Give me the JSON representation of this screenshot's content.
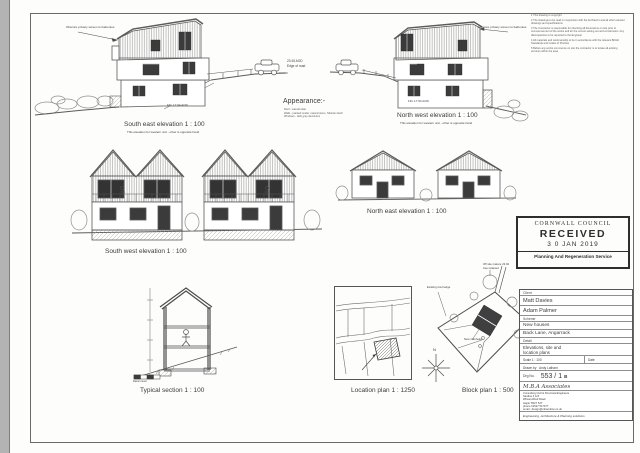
{
  "colors": {
    "ink": "#3c3c3c",
    "line": "#5a5a5a",
    "window": "#3b3b3b",
    "stamp": "#2e2e2e"
  },
  "elevations": {
    "south_east": {
      "title": "South east elevation  1 : 100",
      "subtitle": "This elevation for western unit - other is opposite hand",
      "privacy_note": "Obscure privacy screen to balconies",
      "ffl": "FFL 17.94 AOD",
      "road_level_1": "23.45 AOD",
      "road_level_2": "Edge of road"
    },
    "north_west": {
      "title": "North west elevation  1 : 100",
      "subtitle": "This elevation for western unit - other is opposite hand",
      "privacy_note": "Obscure privacy screen to balconies",
      "ffl": "FFL 17.94 AOD"
    },
    "south_west": {
      "title": "South west elevation  1 : 100"
    },
    "north_east": {
      "title": "North east elevation  1 : 100"
    }
  },
  "appearance": {
    "heading": "Appearance:-",
    "lines": [
      "Roof - natural slate",
      "Walls - painted render, natural stone, Siberian larch",
      "Windows - dark grey aluminium"
    ]
  },
  "notes": [
    "1  This drawing is copyright",
    "2  The drawings to be read in conjunction with the Architect's and all other relevant drawings and specifications",
    "3  The Contractor is responsible for checking all dimensions on site prior to commencement of the works and for the correct setting out and construction. Any discrepancies to be reported to the Engineer",
    "4  All materials and workmanship to be in accordance with the relevant British Standards and Codes of Practice",
    "5  Before any works commence on site the contractor is to locate all existing services within the area"
  ],
  "section": {
    "title": "Typical section  1 : 100",
    "datum_label": "Datum level"
  },
  "location_plan": {
    "title": "Location plan  1 : 1250"
  },
  "block_plan": {
    "title": "Block plan  1 : 500",
    "north": "N",
    "ann_hedge": "Existing low hedge",
    "ann_manholes": "New manholes",
    "ann_tree_1": "Off site mature 23.02",
    "ann_tree_2": "tree retained"
  },
  "stamp": {
    "line1": "CORNWALL COUNCIL",
    "line2": "RECEIVED",
    "line3": "3 0 JAN 2019",
    "line4": "Planning And Regeneration Service"
  },
  "title_block": {
    "client_label": "Client",
    "client1": "Matt Davies",
    "client2": "Adam Palmer",
    "scheme_label": "Scheme",
    "scheme1": "New houses",
    "scheme2": "Back Lane, Angarrack",
    "detail_label": "Detail",
    "detail1": "Elevations, site and",
    "detail2": "location plans",
    "scale_label": "Scale   1 : 100",
    "date_label": "Date",
    "drawnby_label": "Drawn by",
    "drawnby": "Andy Latham",
    "drg_label": "Drg No.",
    "drg_no": "553 / 1",
    "drg_rev": "B",
    "firm": "M.B.A Associates",
    "firm_lines": [
      "Consulting Civil & Structural Engineers",
      "Studios 4 & 8",
      "Wheal Alfred Road",
      "Hayle TR27 5JT",
      "phone 01527 517377",
      "email : design@mbaonline.co.uk"
    ],
    "tagline": "Engineering, Architecture & Planning solutions"
  }
}
